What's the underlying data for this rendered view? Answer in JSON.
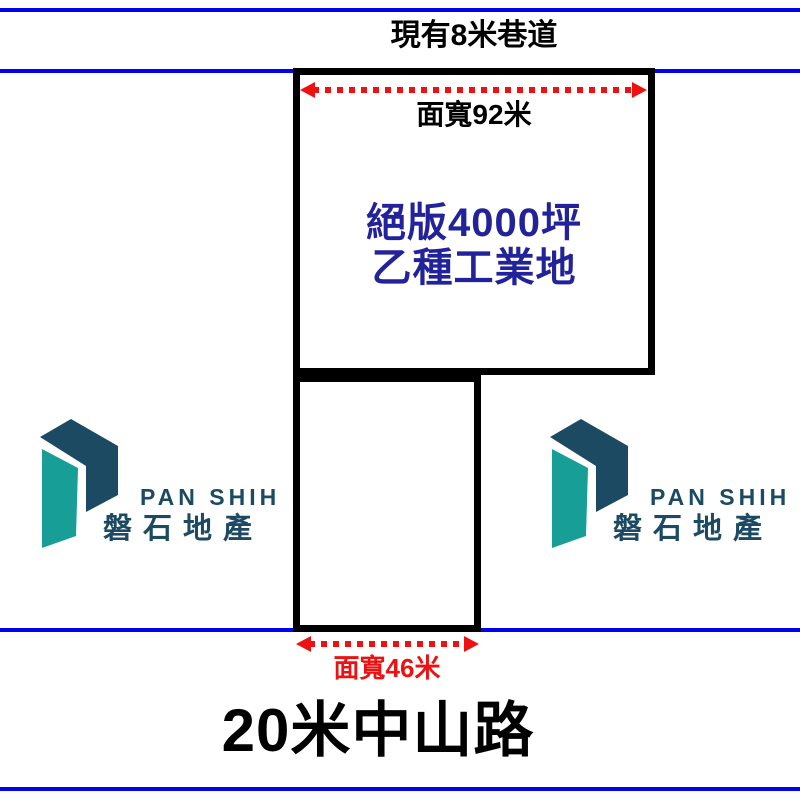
{
  "colors": {
    "blue_line": "#0202ee",
    "navy_text": "#22229b",
    "red": "#ee1111",
    "ink": "#000000",
    "logo_navy": "#1c4a63",
    "logo_teal": "#179e96"
  },
  "top_road": {
    "label": "現有8米巷道"
  },
  "parcel_main": {
    "width_label": "面寬92米",
    "headline_line1": "絕版4000坪",
    "headline_line2": "乙種工業地"
  },
  "parcel_front": {
    "width_label": "面寬46米"
  },
  "bottom_road": {
    "label": "20米中山路"
  },
  "logo": {
    "brand_en": "PAN SHIH",
    "brand_zh": "磐石地產"
  }
}
